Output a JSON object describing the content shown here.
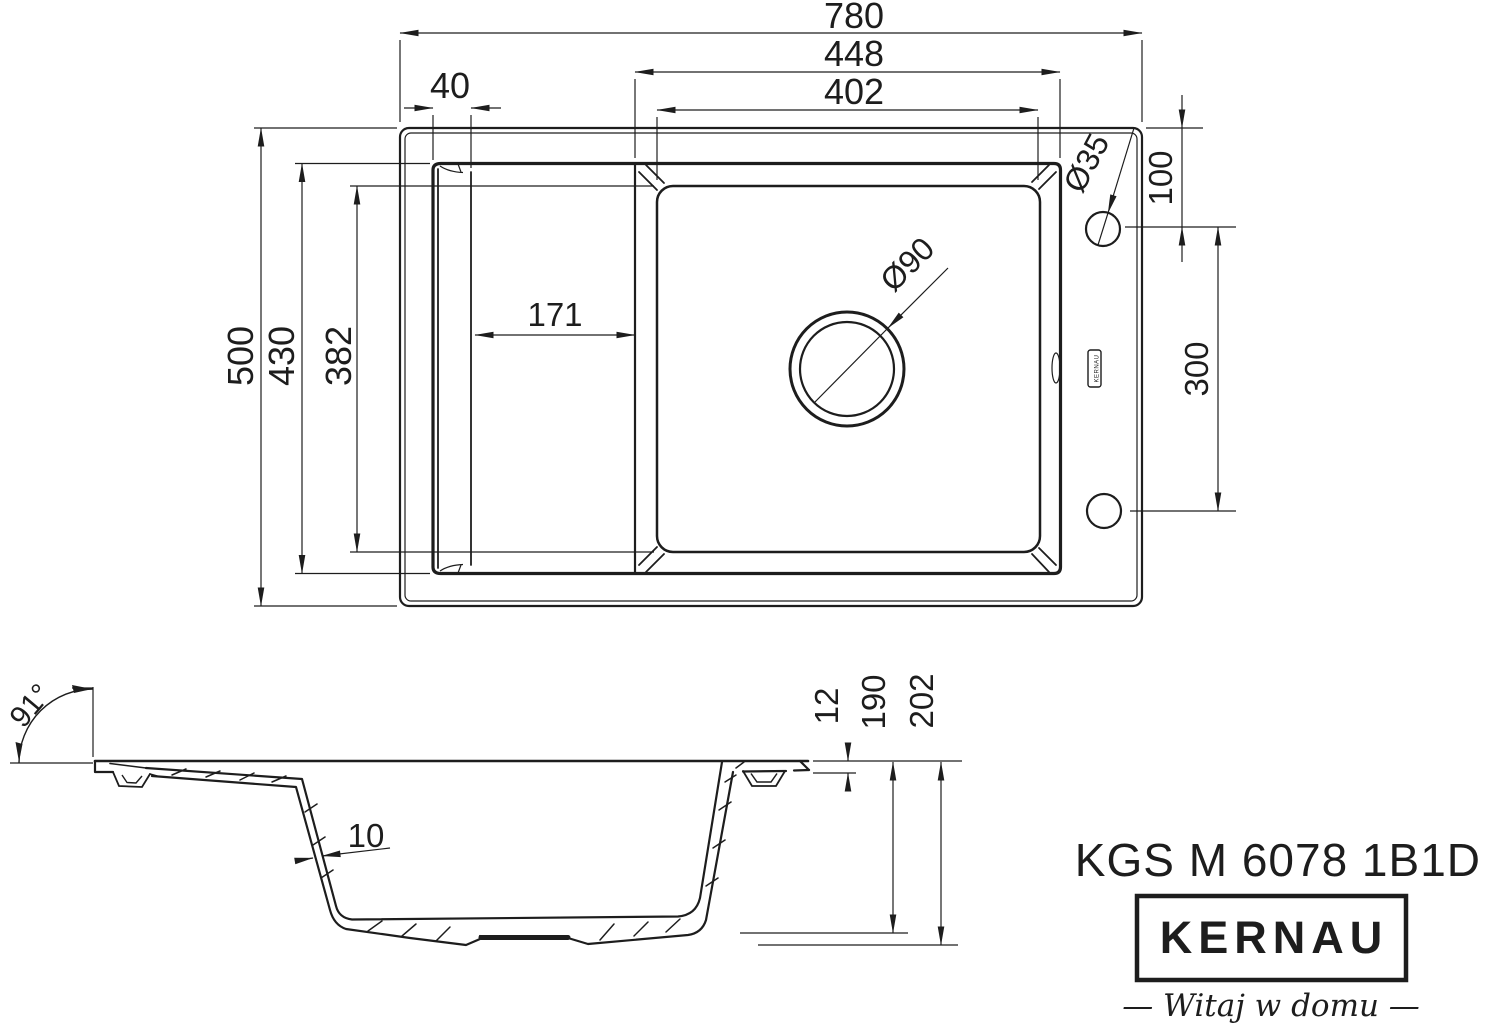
{
  "product": {
    "model": "KGS M 6078 1B1D",
    "brand": "KERNAU",
    "tagline": "—  Witaj w domu  —"
  },
  "colors": {
    "line": "#1d1d1d",
    "background": "#ffffff"
  },
  "top_view": {
    "badge_label": "KERNAU",
    "dims": {
      "overall_width": "780",
      "bowl_outer_width": "448",
      "bowl_inner_width": "402",
      "drainer_edge": "40",
      "overall_depth": "500",
      "recess_depth": "430",
      "bowl_inner_depth": "382",
      "drainer_length": "171",
      "drain_diameter": "Ø90",
      "tap_hole_diameter": "Ø35",
      "tap_hole_offset": "100",
      "hole_spacing": "300"
    }
  },
  "side_view": {
    "dims": {
      "rim_angle": "91°",
      "rim_thickness": "12",
      "bowl_depth": "190",
      "overall_height": "202",
      "wall_thickness": "10"
    }
  }
}
